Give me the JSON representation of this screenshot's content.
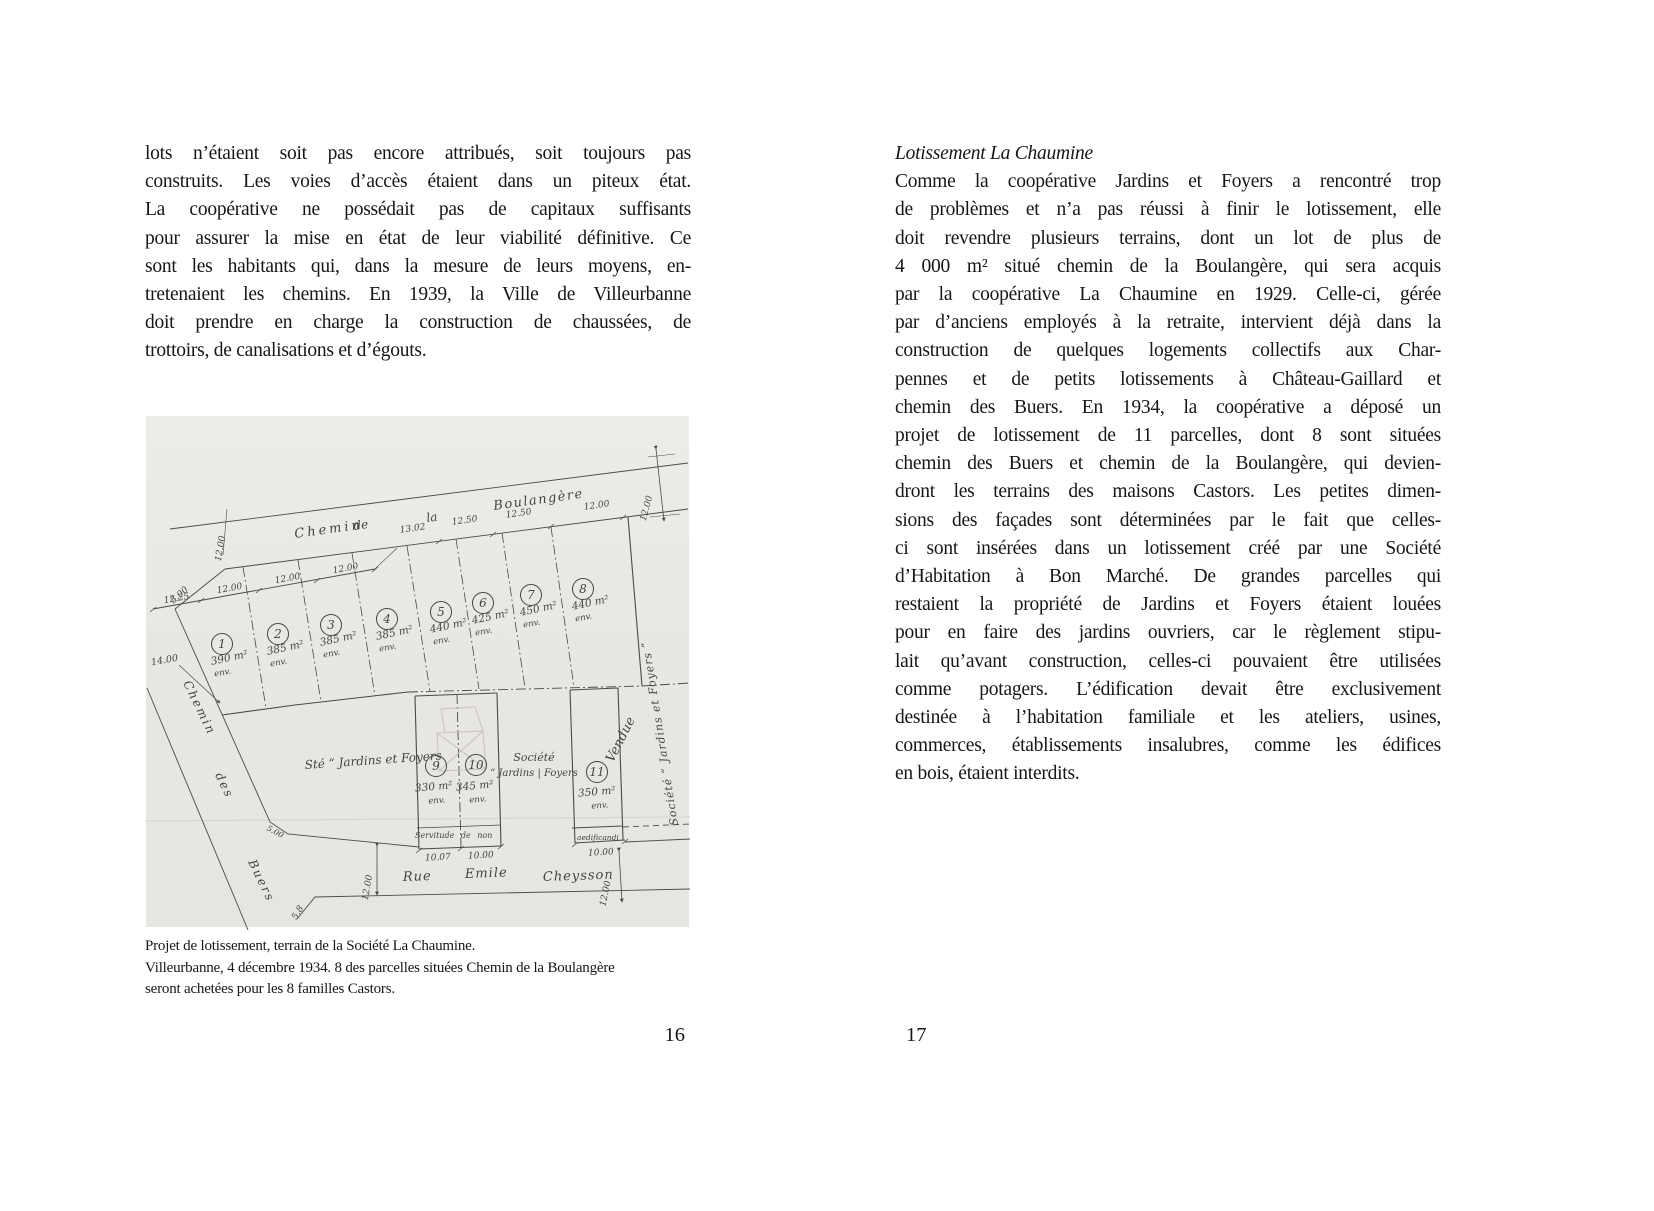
{
  "left_page": {
    "body_lines": [
      "lots n’étaient soit pas encore attribués, soit toujours pas",
      "construits. Les voies d’accès étaient dans un piteux état.",
      "La coopérative ne possédait pas de capitaux suffisants",
      "pour assurer la mise en état de leur viabilité définitive. Ce",
      "sont les habitants qui, dans la mesure de leurs moyens, en-",
      "tretenaient les chemins. En 1939, la Ville de Villeurbanne",
      "doit prendre en charge la construction de chaussées, de",
      "trottoirs, de canalisations et d’égouts."
    ],
    "caption_lines": [
      "Projet de lotissement, terrain de la Société La Chaumine.",
      "Villeurbanne, 4 décembre 1934. 8 des parcelles situées Chemin de la Boulangère",
      "seront achetées pour les 8 familles Castors."
    ],
    "page_number": "16"
  },
  "right_page": {
    "heading": "Lotissement La Chaumine",
    "body_lines": [
      "Comme la coopérative Jardins et Foyers a rencontré trop",
      "de problèmes et n’a pas réussi à finir le lotissement, elle",
      "doit revendre plusieurs terrains, dont un lot de plus de",
      "4 000 m² situé chemin de la Boulangère, qui sera acquis",
      "par la coopérative La Chaumine en 1929. Celle-ci, gérée",
      "par d’anciens employés à la retraite, intervient déjà dans la",
      "construction de quelques logements collectifs aux Char-",
      "pennes et de petits lotissements à Château-Gaillard et",
      "chemin des Buers. En 1934, la coopérative a déposé un",
      "projet de lotissement de 11 parcelles, dont 8 sont situées",
      "chemin des Buers et chemin de la Boulangère, qui devien-",
      "dront les terrains des maisons Castors. Les petites dimen-",
      "sions des façades sont déterminées par le fait que celles-",
      "ci sont insérées dans un lotissement créé par une Société",
      "d’Habitation à Bon Marché. De grandes parcelles qui",
      "restaient la propriété de Jardins et Foyers étaient louées",
      "pour en faire des jardins ouvriers, car le règlement stipu-",
      "lait qu’avant construction, celles-ci pouvaient être utilisées",
      "comme potagers. L’édification devait être exclusivement",
      "destinée à l’habitation familiale et les ateliers, usines,",
      "commerces, établissements insalubres, comme les édifices",
      "en bois, étaient interdits."
    ],
    "page_number": "17"
  },
  "figure": {
    "paper_color": "#eae8e4",
    "ink_color": "#4a4a4a",
    "pencil_color": "#c6c3bb",
    "streets": {
      "top_words": [
        "Chemin",
        "de",
        "la",
        "Boulangère"
      ],
      "left_words": [
        "Chemin",
        "des",
        "Buers"
      ],
      "bottom_words": [
        "Rue",
        "Emile",
        "Cheysson"
      ]
    },
    "top_dims": [
      "12.25",
      "12.00",
      "12.00",
      "12.00",
      "13.02",
      "12.50",
      "12.50",
      "12.00"
    ],
    "parcels_top": [
      {
        "n": "1",
        "area": "390 m²",
        "approx": "env."
      },
      {
        "n": "2",
        "area": "385 m²",
        "approx": "env."
      },
      {
        "n": "3",
        "area": "385 m²",
        "approx": "env."
      },
      {
        "n": "4",
        "area": "385 m²",
        "approx": "env."
      },
      {
        "n": "5",
        "area": "440 m²",
        "approx": "env."
      },
      {
        "n": "6",
        "area": "425 m²",
        "approx": "env."
      },
      {
        "n": "7",
        "area": "450 m²",
        "approx": "env."
      },
      {
        "n": "8",
        "area": "440 m²",
        "approx": "env."
      }
    ],
    "parcels_bottom": [
      {
        "n": "9",
        "area": "330 m²",
        "approx": "env."
      },
      {
        "n": "10",
        "area": "345 m²",
        "approx": "env."
      },
      {
        "n": "11",
        "area": "350 m²",
        "approx": "env."
      }
    ],
    "labels": {
      "big_parcel": "Sté “ Jardins et Foyers",
      "societe_1": "Société",
      "societe_2": "“ Jardins | Foyers",
      "right_vertical": "Société “ Jardins et Foyers ”",
      "servitude": "Servitude  de  non",
      "aedificandi": "aedificandi",
      "pencil_note": "Vendue"
    },
    "dims": {
      "street_width_left": "12.00",
      "top_right": "12.00",
      "left_edge": "14.00",
      "bevel_top": "5.00",
      "bevel_south": "5.00",
      "p9": "10.07",
      "p10": "10.00",
      "p11": "10.00",
      "bottom_left": "12.00",
      "bottom_right": "12.00",
      "bottom_bevel": "5.8"
    }
  }
}
